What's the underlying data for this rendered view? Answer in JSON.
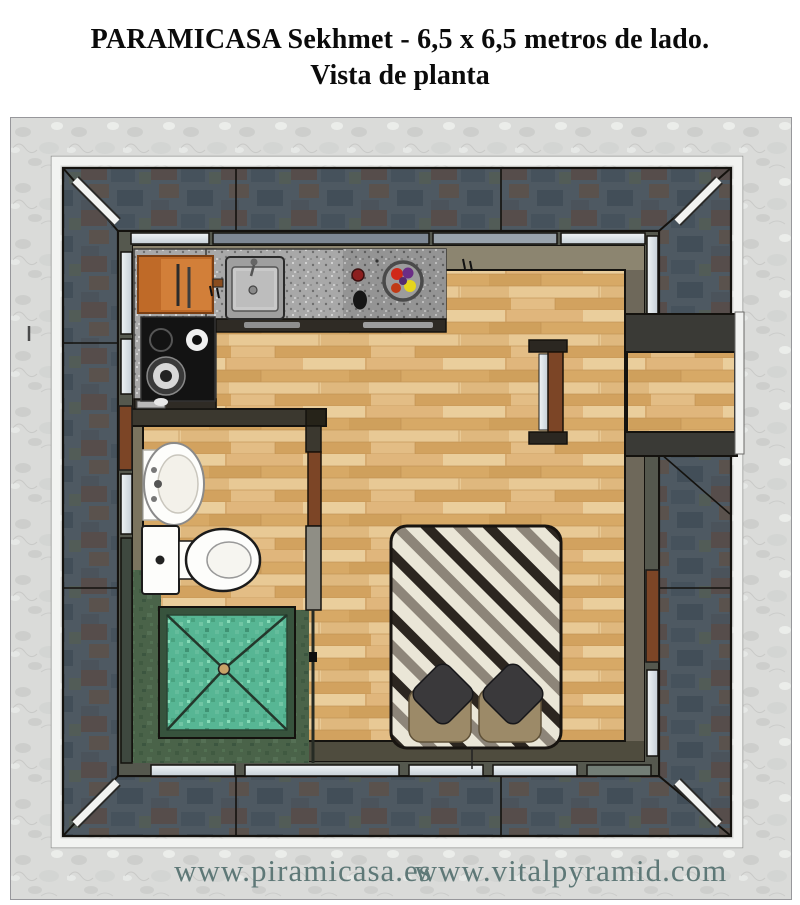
{
  "page": {
    "title_line1": "PARAMICASA Sekhmet - 6,5 x 6,5 metros de lado.",
    "title_line2": "Vista de planta"
  },
  "footer": {
    "url_left": "www.piramicasa.es",
    "url_right": "www.vitalpyramid.com"
  },
  "colors": {
    "marble": "#dadbd9",
    "slate": "#4e5962",
    "trim_white": "#f2f3f1",
    "wood": "#ddb278",
    "counter_gray": "#a8a8a8",
    "counter_dark": "#949494",
    "cutting_board": "#bf6a28",
    "cutting_board_light": "#d5823c",
    "stove_black": "#131313",
    "window_glass": "#c5cfd7",
    "green_floor": "#4a6349",
    "shower_teal": "#57b694",
    "shower_border": "#37533d",
    "bed_cream": "#eae6d7",
    "bed_dark": "#2c2620",
    "bed_gray": "#8d8579",
    "pillow_khaki": "#9c8a68",
    "pillow_dark": "#3a393b",
    "door_brown": "#7c4526",
    "fixture_white": "#fdfdfb",
    "fruit_red": "#d02818",
    "fruit_purple": "#6b2d86",
    "fruit_yellow": "#e6d41c",
    "footer_text": "#5e7877"
  }
}
